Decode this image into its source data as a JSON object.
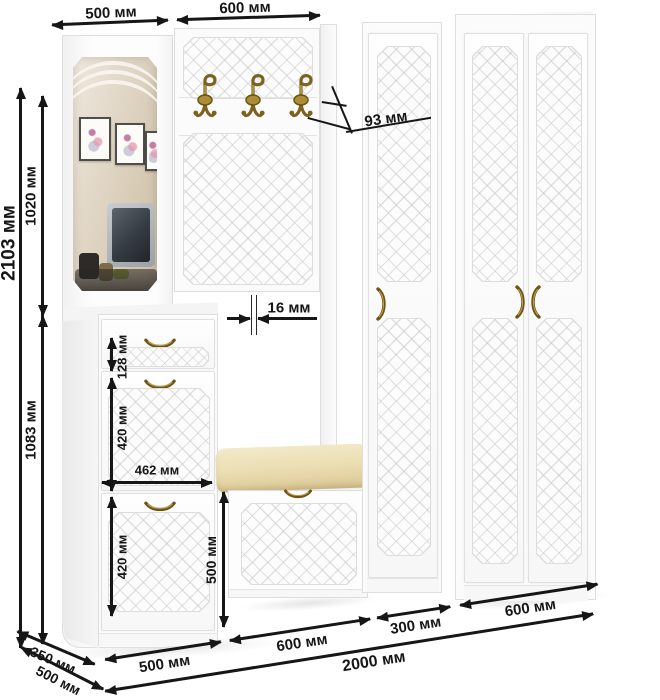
{
  "figure": {
    "kind": "furniture-dimension-diagram",
    "units": "мм"
  },
  "dims": {
    "mirror_width": "500 мм",
    "rack_width": "600 мм",
    "total_height": "2103 мм",
    "upper_height": "1020 мм",
    "lower_height": "1083 мм",
    "hook_depth": "93 мм",
    "panel_thickness": "16 мм",
    "drawer_height": "128 мм",
    "upper_door_height": "420 мм",
    "inner_width": "462 мм",
    "lower_door_height": "420 мм",
    "bench_column_height": "500 мм",
    "shoe_unit_width": "500 мм",
    "bench_section_width": "600 мм",
    "narrow_wardrobe_width": "300 мм",
    "double_wardrobe_width": "600 мм",
    "total_width": "2000 мм",
    "upper_depth": "350 мм",
    "lower_depth": "500 мм"
  },
  "colors": {
    "dimension_ink": "#161616",
    "brass": "#7c621e",
    "cushion_beige": "#ecdfb4",
    "furniture_white": "#fbfbfb",
    "quilt_line": "#dcdcdc"
  },
  "icons": {
    "coat-hook-icon": "double-prong brass coat hook",
    "door-handle-icon": "arched brass handle"
  }
}
